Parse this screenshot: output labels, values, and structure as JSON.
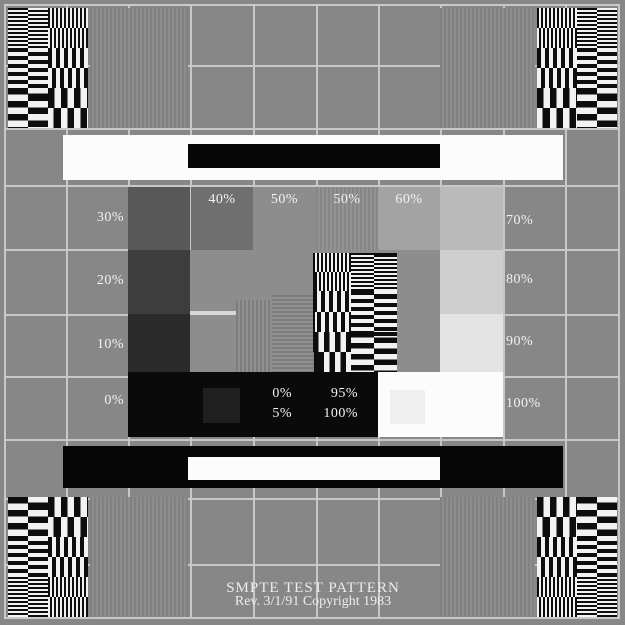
{
  "pattern": {
    "title": "SMPTE TEST PATTERN",
    "revision": "Rev. 3/1/91 Copyright 1983"
  },
  "labels": {
    "left": [
      "30%",
      "20%",
      "10%",
      "0%"
    ],
    "top": [
      "40%",
      "50%",
      "50%",
      "60%"
    ],
    "right": [
      "70%",
      "80%",
      "90%",
      "100%"
    ],
    "pluge": {
      "col1": [
        "0%",
        "5%"
      ],
      "col2": [
        "95%",
        "100%"
      ]
    }
  },
  "colors": {
    "background": "#878787",
    "grid_line": "#c8c8c8",
    "reference_white": "#fcfcfc",
    "reference_black": "#060606",
    "burst_dark": "#0d0d0d",
    "burst_light": "#f2f2f2",
    "marker_line": "#d8d8d8",
    "steps": {
      "0": "#0a0a0a",
      "5": "#202020",
      "10": "#2a2a2a",
      "20": "#3d3d3d",
      "30": "#585858",
      "40": "#6f6f6f",
      "50": "#8d8d8d",
      "60": "#a3a3a3",
      "70": "#bababa",
      "80": "#cecece",
      "90": "#e4e4e4",
      "95": "#efefef",
      "100": "#fcfcfc"
    }
  }
}
